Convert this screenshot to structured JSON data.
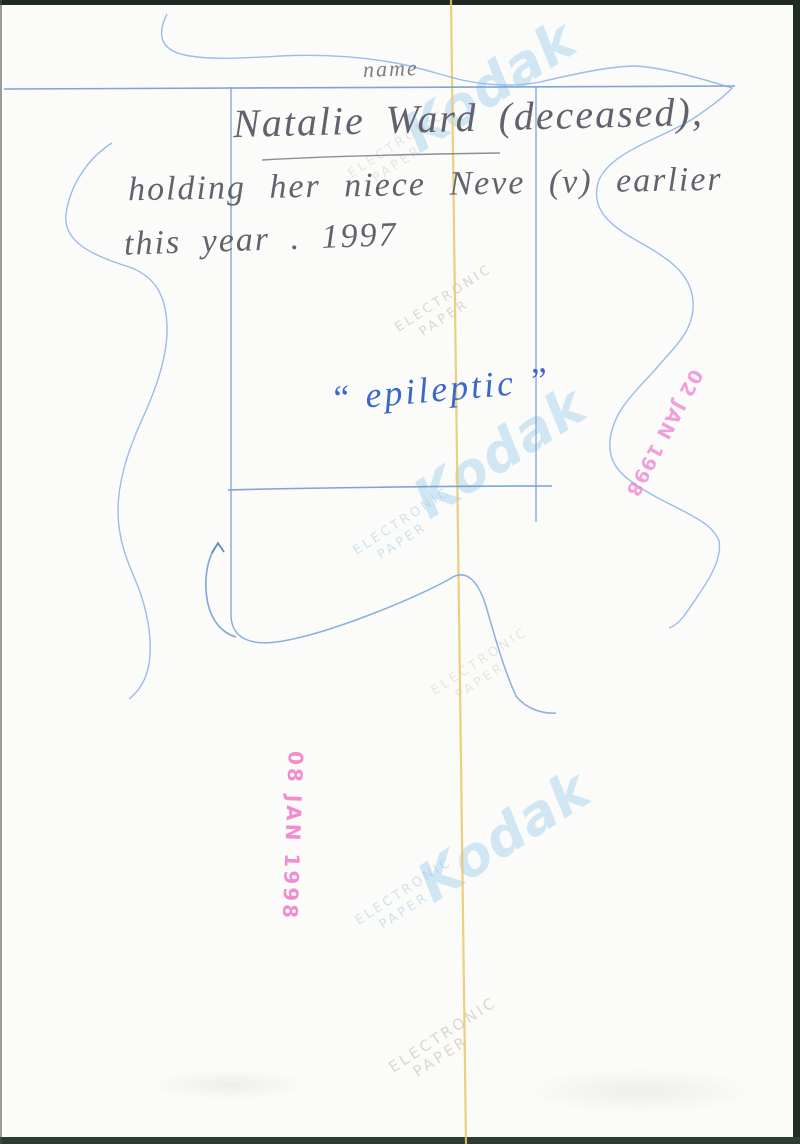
{
  "page": {
    "type_label": "name",
    "caption": {
      "line1": "Natalie Ward (deceased),",
      "line2": "holding her niece Neve (v) earlier",
      "line3": "this year . 1997"
    },
    "annotation": "“ epileptic ”",
    "stamps": {
      "stamp1": "02 JAN 1998",
      "stamp2": "08 JAN 1998"
    },
    "watermark": {
      "brand": "Kodak",
      "small_line1": "ELECTRONIC",
      "small_line2": "PAPER"
    },
    "colors": {
      "ruled_line_blue": "#6f9bd4",
      "squiggle_blue": "#8ab2e4",
      "pen_blue": "#3b66cc",
      "pencil_grey": "#62626e",
      "stamp_pink": "#ee80cd",
      "guide_yellow": "#e7c868",
      "watermark_blue": "#94c7eb",
      "paper_white": "#fbfbf9"
    }
  }
}
